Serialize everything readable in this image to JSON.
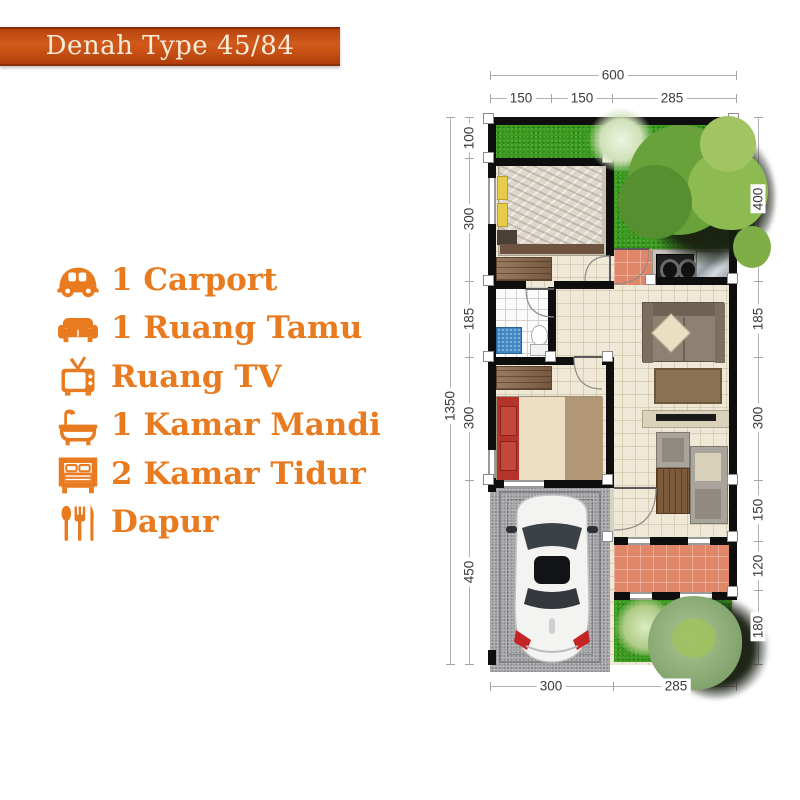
{
  "banner": {
    "title": "Denah Type 45/84"
  },
  "legend": {
    "items": [
      {
        "icon": "car-icon",
        "label": "1 Carport"
      },
      {
        "icon": "sofa-icon",
        "label": "1 Ruang Tamu"
      },
      {
        "icon": "tv-icon",
        "label": "Ruang TV"
      },
      {
        "icon": "bathtub-icon",
        "label": "1 Kamar Mandi"
      },
      {
        "icon": "bed-icon",
        "label": "2 Kamar Tidur"
      },
      {
        "icon": "utensils-icon",
        "label": "Dapur"
      }
    ]
  },
  "floorplan": {
    "dims": {
      "top_total": "600",
      "top": [
        "150",
        "150",
        "285"
      ],
      "left_total": "1350",
      "left": [
        "100",
        "300",
        "185",
        "300",
        "450"
      ],
      "right": [
        "400",
        "185",
        "300",
        "150",
        "120",
        "180"
      ],
      "bottom": [
        "300",
        "285"
      ]
    }
  },
  "colors": {
    "accent_orange": "#e87a1f",
    "banner_orange": "#c94f13",
    "wall_black": "#0e0e0e",
    "grass_green": "#3a9a1d",
    "terrace_salmon": "#df8768",
    "floor_cream": "#f0e8d7",
    "carport_gray": "#a1a1a4",
    "mat_blue": "#4187c5",
    "bed_red": "#b5342a"
  }
}
